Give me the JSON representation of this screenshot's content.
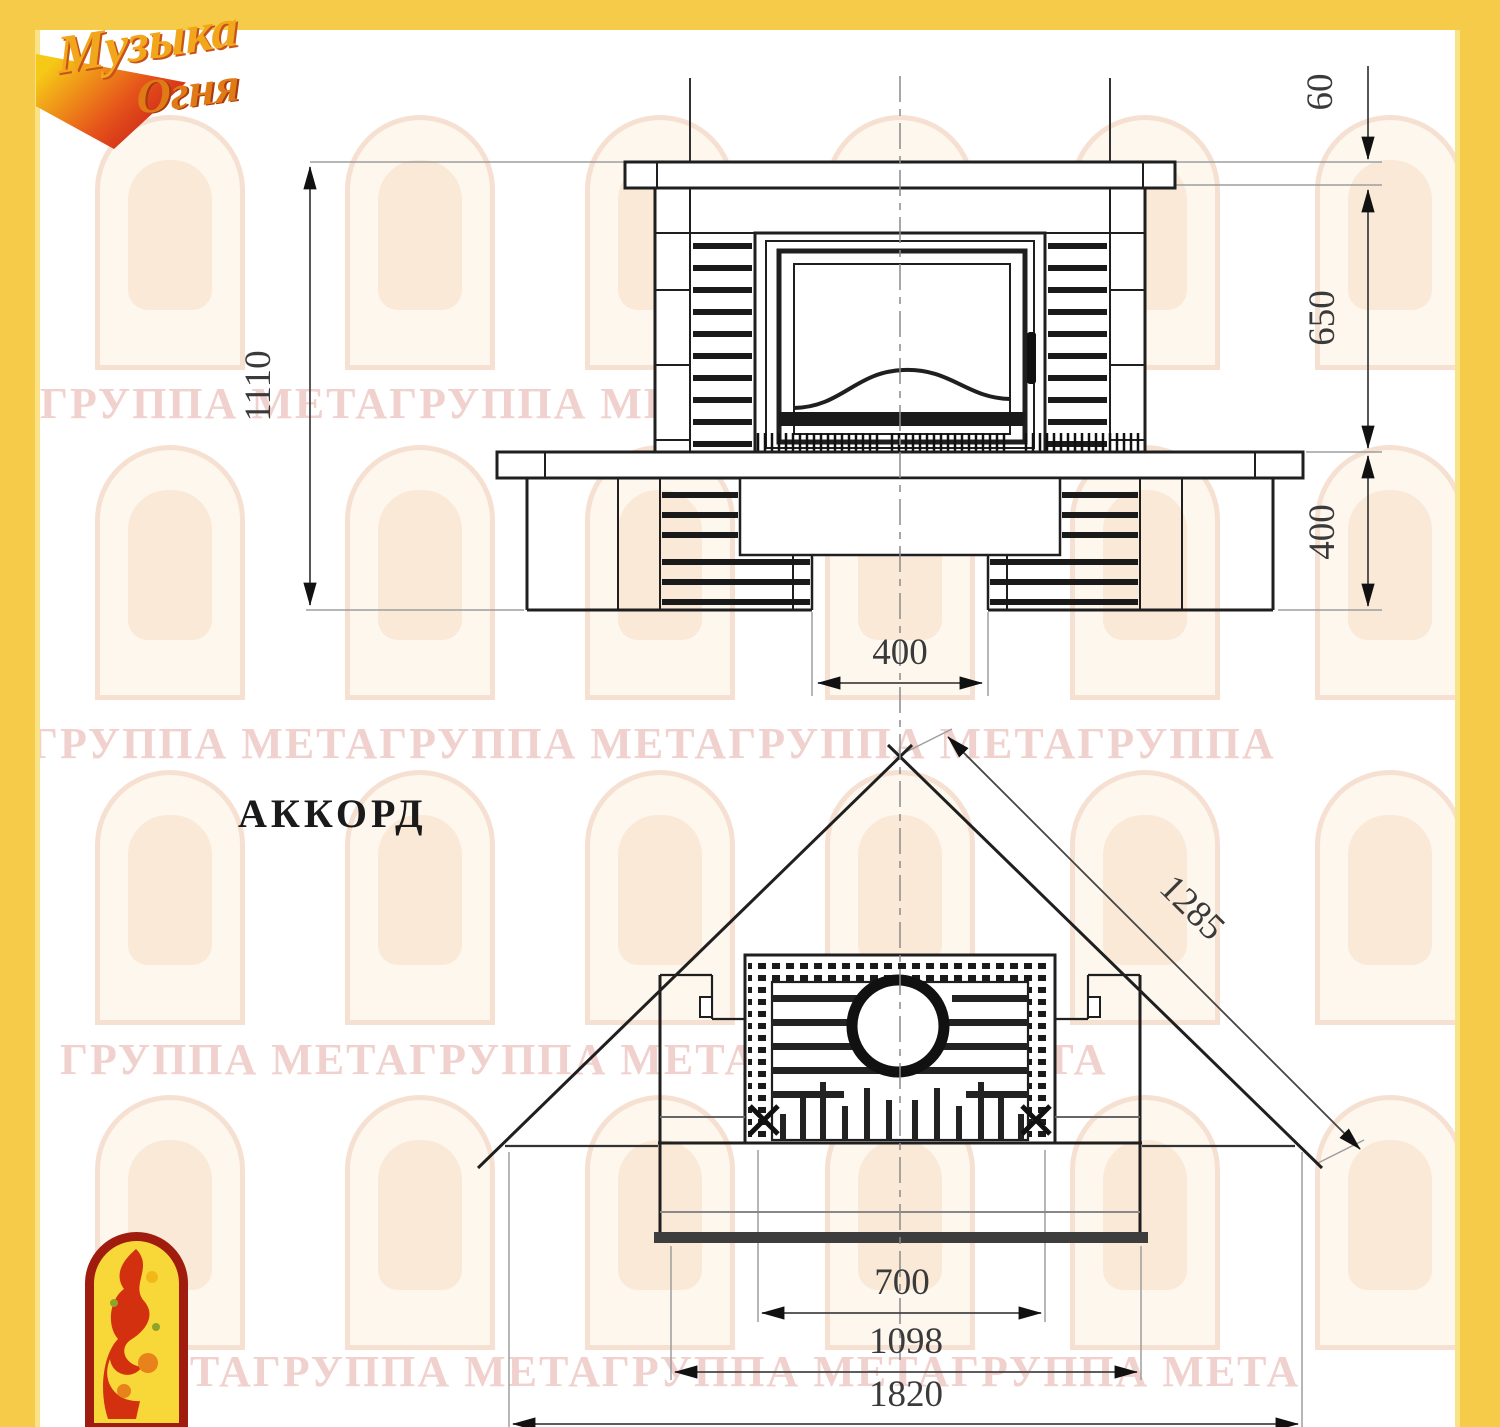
{
  "page": {
    "frame_color": "#F6CB49",
    "drawing_line_color": "#1f1f1f",
    "watermark_color": "#E4ACA5"
  },
  "logo": {
    "word1": "Музыка",
    "word2": "Огня"
  },
  "drawing": {
    "model_name": "АККОРД",
    "front_view": {
      "dim_total_height": "1110",
      "dim_mantel_thickness": "60",
      "dim_mantel_to_hearth": "650",
      "dim_base_height": "400",
      "dim_recess_width": "400"
    },
    "plan_view": {
      "dim_diagonal_side": "1285",
      "dim_opening_width": "700",
      "dim_front_width": "1098",
      "dim_overall_width": "1820"
    }
  },
  "watermark": {
    "rows": [
      "ГРУППА МЕТАГРУППА МЕТАГРУППА МЕТА",
      "ГРУППА МЕТАГРУППА МЕТАГРУППА МЕТАГРУППА",
      "ГРУППА МЕТАГРУППА МЕТАГРУППА МЕТА",
      "МЕТАГРУППА МЕТАГРУППА МЕТАГРУППА МЕТА"
    ]
  }
}
